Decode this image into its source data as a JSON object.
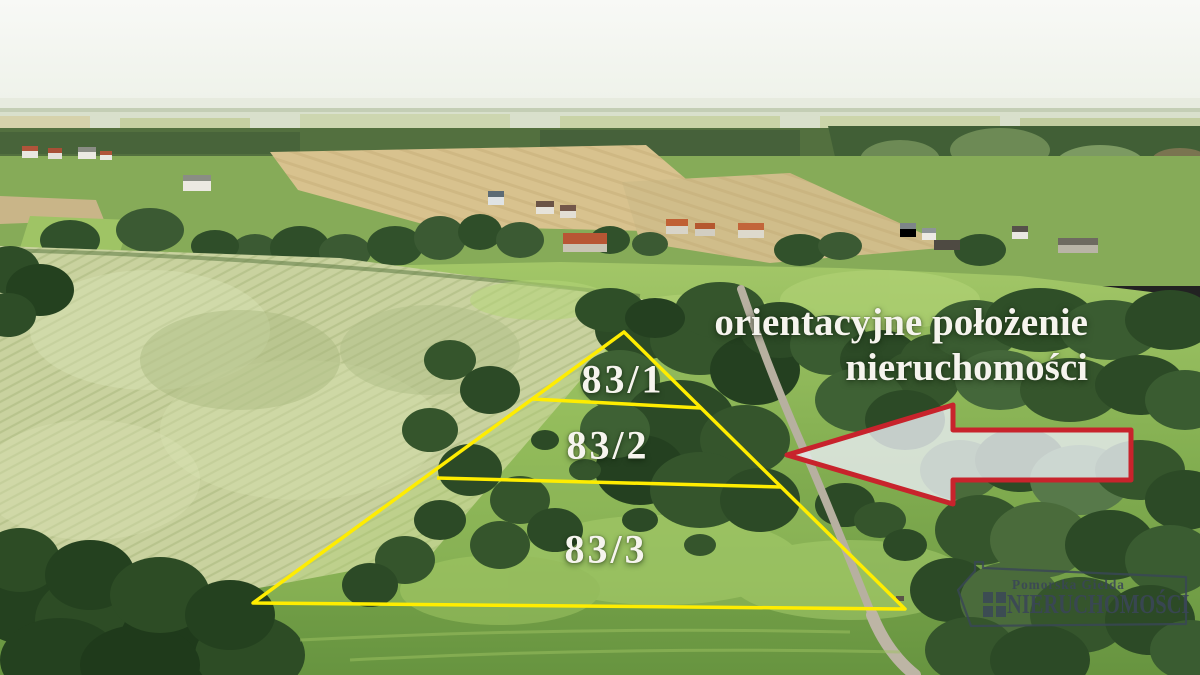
{
  "overlay": {
    "caption": {
      "line1": "orientacyjne położenie",
      "line2": "nieruchomości"
    },
    "plots": [
      {
        "label": "83/1"
      },
      {
        "label": "83/2"
      },
      {
        "label": "83/3"
      }
    ],
    "colors": {
      "plot_boundary_yellow": "#FFED00",
      "arrow_fill": "#E7ECEF",
      "arrow_border": "#C8232C",
      "overlay_text": "#F6F4EE"
    },
    "icons": {
      "direction_arrow": "left-arrow-icon"
    }
  },
  "watermark": {
    "brand_top": "Pomorska Giełda",
    "brand_bottom": "NIERUCHOMOŚCI",
    "color": "#3C4A5C",
    "icons": {
      "house": "house-outline-icon",
      "window": "window-grid-icon"
    }
  }
}
